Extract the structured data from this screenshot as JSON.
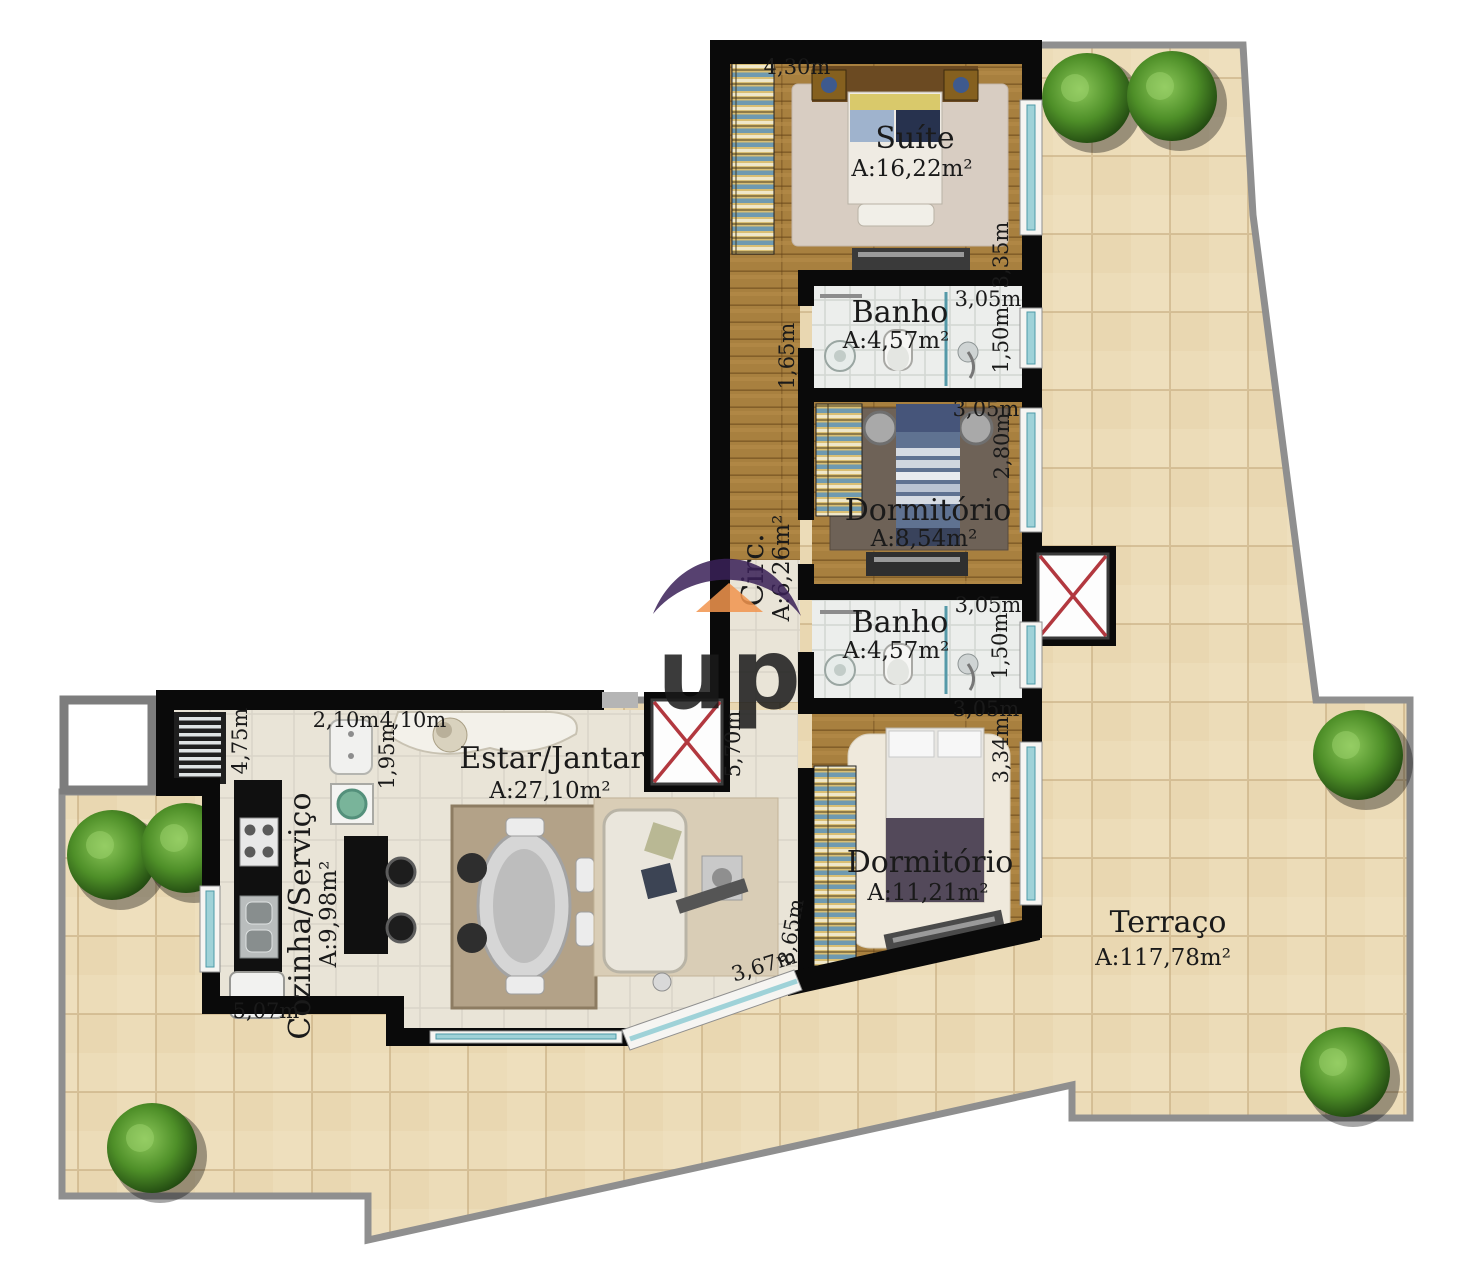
{
  "logo": {
    "letters": "up"
  },
  "rooms": {
    "suite": {
      "name": "Suíte",
      "area": "A:16,22m²"
    },
    "banho1": {
      "name": "Banho",
      "area": "A:4,57m²"
    },
    "dorm1": {
      "name": "Dormitório",
      "area": "A:8,54m²"
    },
    "banho2": {
      "name": "Banho",
      "area": "A:4,57m²"
    },
    "dorm2": {
      "name": "Dormitório",
      "area": "A:11,21m²"
    },
    "circ": {
      "name": "Circ.",
      "area": "A:6,26m²"
    },
    "estar": {
      "name": "Estar/Jantar",
      "area": "A:27,10m²"
    },
    "cozinha": {
      "name": "Cozinha/Serviço",
      "area": "A:9,98m²"
    },
    "terraco": {
      "name": "Terraço",
      "area": "A:117,78m²"
    }
  },
  "dimensions": {
    "suite_top": "4,30m",
    "suite_right": "3,35m",
    "banho1_top": "3,05m",
    "banho1_right": "1,50m",
    "banho1_left": "1,65m",
    "dorm1_top": "3,05m",
    "dorm1_right": "2,80m",
    "banho2_top": "3,05m",
    "banho2_right": "1,50m",
    "dorm2_top": "3,05m",
    "dorm2_right": "3,34m",
    "dorm2_left": "8,65m",
    "dorm2_bottom": "3,67m",
    "circ_height": "5,70m",
    "estar_top": "4,10m",
    "estar_left": "1,95m",
    "cozinha_top": "2,10m",
    "cozinha_left": "4,75m",
    "cozinha_bottom": "5,07m"
  },
  "colors": {
    "wall": "#0a0a0a",
    "terrace_tile": "#ecdcb8",
    "terrace_border": "#8f8f8f",
    "window_glass": "#9fd2d8",
    "elevator_x": "#b2383f",
    "logo_purple_dark": "#3a2158",
    "logo_purple_light": "#8a5cb8",
    "logo_orange": "#f2954e",
    "wood": "#a8803f",
    "bush_green": "#4e8f28"
  }
}
